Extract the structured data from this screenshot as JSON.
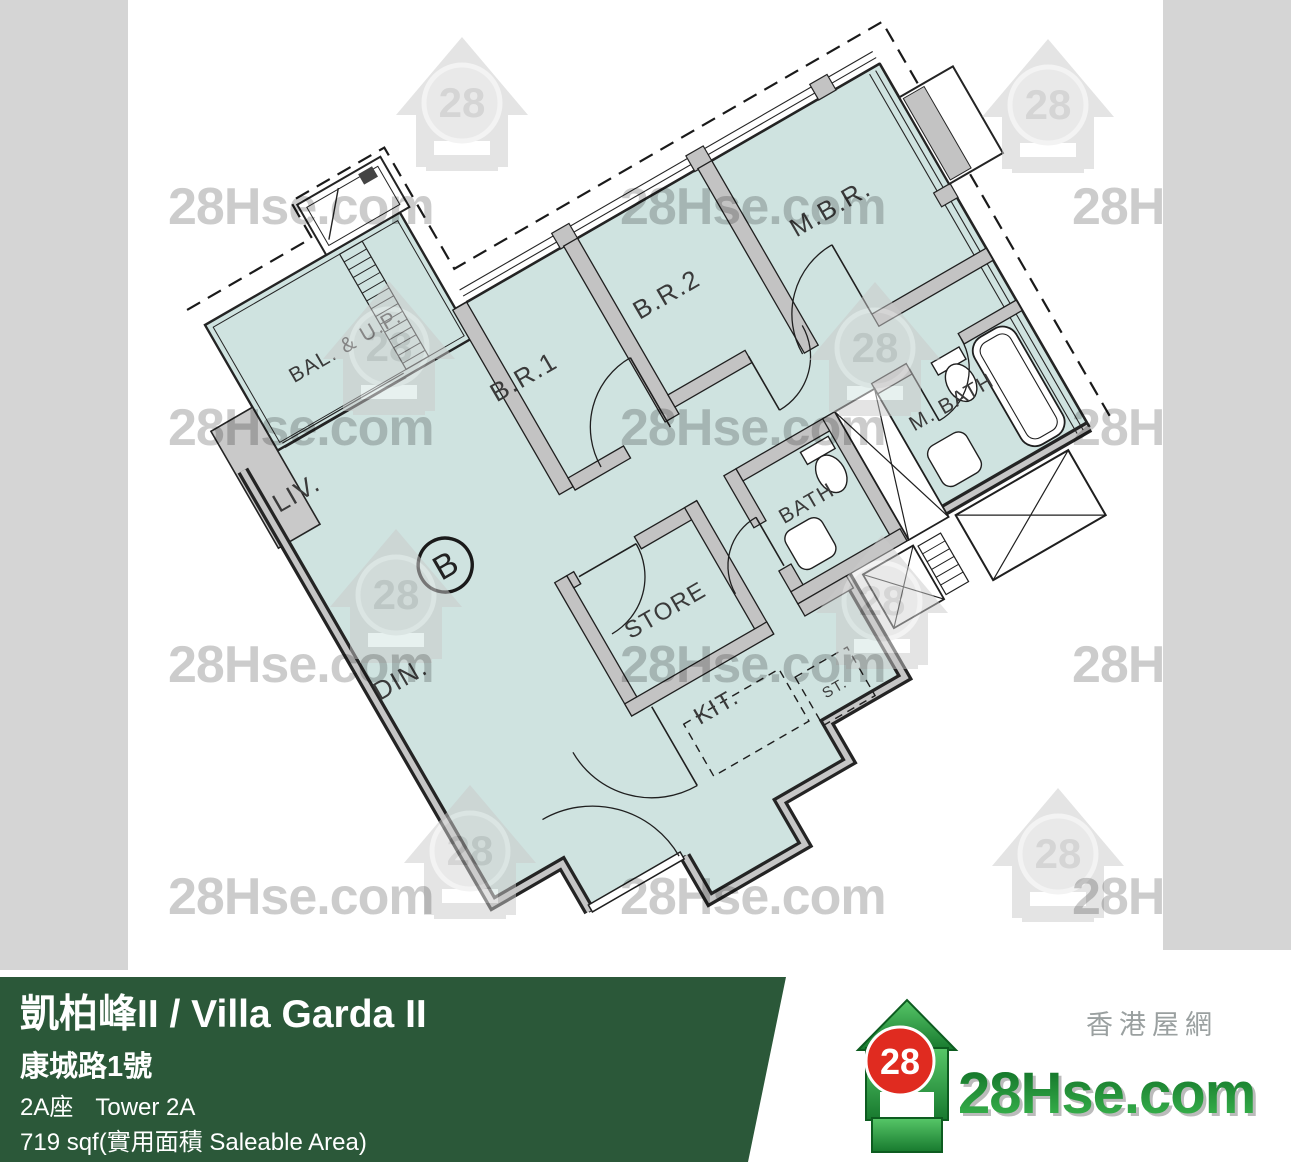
{
  "watermark": {
    "text": "28Hse.com",
    "badge": "28"
  },
  "plan": {
    "unit_marker": "B",
    "labels": [
      {
        "id": "bal",
        "text": "BAL. & U.P."
      },
      {
        "id": "br1",
        "text": "B.R.1"
      },
      {
        "id": "br2",
        "text": "B.R.2"
      },
      {
        "id": "mbr",
        "text": "M.B.R."
      },
      {
        "id": "mbath",
        "text": "M. BATH"
      },
      {
        "id": "bath",
        "text": "BATH"
      },
      {
        "id": "store",
        "text": "STORE"
      },
      {
        "id": "kit",
        "text": "KIT."
      },
      {
        "id": "st",
        "text": "ST."
      },
      {
        "id": "liv",
        "text": "LIV."
      },
      {
        "id": "din",
        "text": "DIN."
      }
    ]
  },
  "banner": {
    "title": "凱柏峰II / Villa Garda II",
    "address": "康城路1號",
    "tower_zh": "2A座",
    "tower_en": "Tower 2A",
    "area": "719 sqf(實用面積 Saleable Area)",
    "bg_color": "#2b5839"
  },
  "logo": {
    "brand": "28Hse.com",
    "badge": "28",
    "tagline": "香港屋網"
  },
  "colors": {
    "floor": "#cfe3e0",
    "wall_gray": "#c3c3c3",
    "line": "#242424",
    "band_gray": "#d5d5d5"
  }
}
